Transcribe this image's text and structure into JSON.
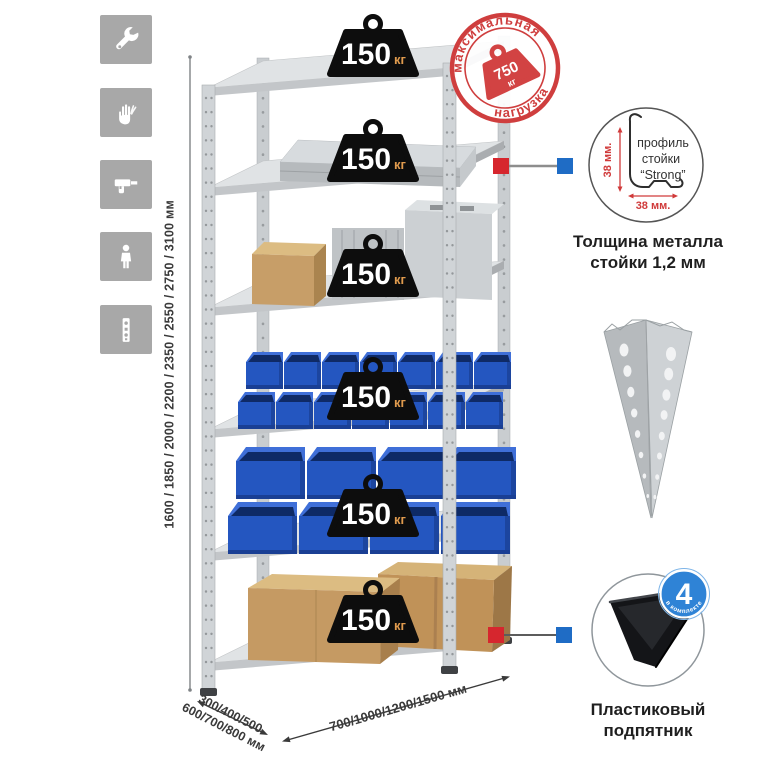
{
  "sidebar": {
    "icons": [
      "wrench",
      "gloves",
      "drill",
      "person",
      "rack-post"
    ]
  },
  "rack": {
    "badges": [
      {
        "value": "150",
        "unit": "кг"
      },
      {
        "value": "150",
        "unit": "кг"
      },
      {
        "value": "150",
        "unit": "кг"
      },
      {
        "value": "150",
        "unit": "кг"
      },
      {
        "value": "150",
        "unit": "кг"
      },
      {
        "value": "150",
        "unit": "кг"
      }
    ],
    "height_options": "1600 / 1850 / 2000 / 2200 / 2350 / 2550 / 2750 / 3100 мм",
    "depth_line1": "300/400/500",
    "depth_line2": "600/700/800 мм",
    "width_options": "700/1000/1200/1500 мм"
  },
  "stamp": {
    "arc_top": "максимальная",
    "arc_bottom": "нагрузка",
    "value": "750",
    "unit": "кг"
  },
  "profile_detail": {
    "line1": "профиль",
    "line2": "стойки",
    "line3": "“Strong”",
    "dim_vertical": "38 мм.",
    "dim_horizontal": "38 мм.",
    "caption1": "Толщина металла",
    "caption2": "стойки 1,2 мм"
  },
  "foot_detail": {
    "badge_value": "4",
    "badge_arc": "в комплекте",
    "caption1": "Пластиковый",
    "caption2": "подпятник"
  },
  "colors": {
    "accent_red": "#d6262e",
    "accent_blue": "#1f6cc5",
    "stamp_red": "#cf3e3e",
    "bin_blue": "#2456c0",
    "cardboard": "#c59a63",
    "metal_gray": "#d4d7d9",
    "icon_tile_gray": "#a8a8a8",
    "badge_black": "#0d0d0d",
    "kg_orange": "#e09b4e"
  }
}
